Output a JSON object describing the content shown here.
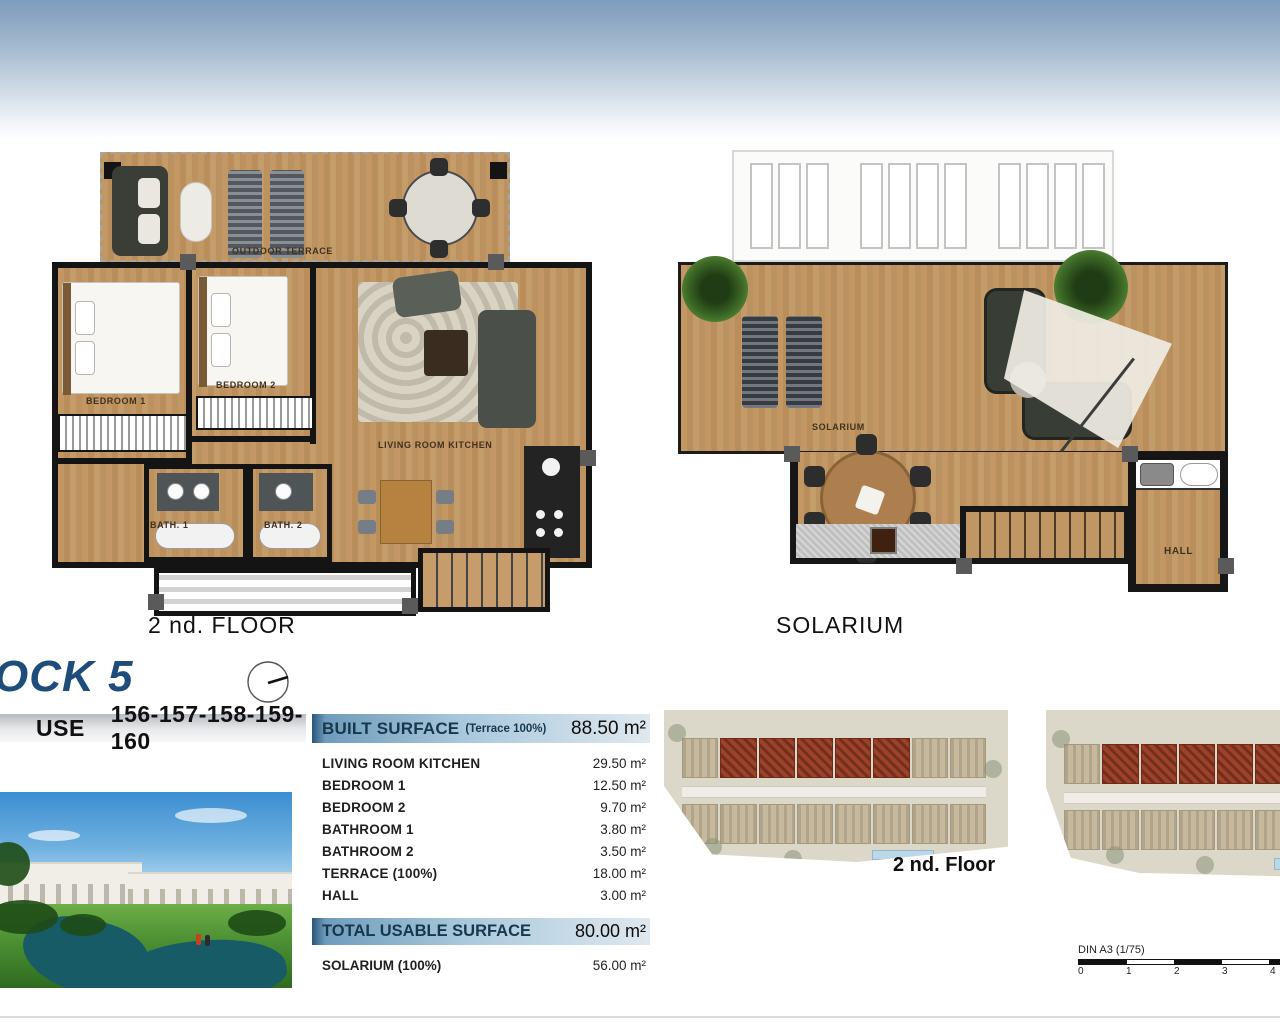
{
  "plan_floor2": {
    "caption": "2 nd. FLOOR",
    "labels": {
      "outdoor_terrace": "OUTDOOR TERRACE",
      "bedroom1": "BEDROOM 1",
      "bedroom2": "BEDROOM 2",
      "living_room_kitchen": "LIVING ROOM KITCHEN",
      "bath1": "BATH. 1",
      "bath2": "BATH. 2"
    }
  },
  "plan_solarium": {
    "caption": "SOLARIUM",
    "labels": {
      "solarium": "SOLARIUM",
      "hall": "HALL"
    }
  },
  "block": {
    "title": "OCK 5",
    "house_label": "USE",
    "house_numbers": "156-157-158-159-160"
  },
  "surface_table": {
    "built": {
      "label": "BUILT SURFACE",
      "note": "(Terrace 100%)",
      "value": "88.50 m²"
    },
    "rows": [
      {
        "label": "LIVING ROOM KITCHEN",
        "value": "29.50 m²"
      },
      {
        "label": "BEDROOM 1",
        "value": "12.50 m²"
      },
      {
        "label": "BEDROOM 2",
        "value": "9.70 m²"
      },
      {
        "label": "BATHROOM 1",
        "value": "3.80 m²"
      },
      {
        "label": "BATHROOM 2",
        "value": "3.50 m²"
      },
      {
        "label": "TERRACE (100%)",
        "value": "18.00 m²"
      },
      {
        "label": "HALL",
        "value": "3.00 m²"
      }
    ],
    "total": {
      "label": "TOTAL USABLE SURFACE",
      "value": "80.00 m²"
    },
    "solarium_row": {
      "label": "SOLARIUM (100%)",
      "value": "56.00 m²"
    }
  },
  "site_plans": {
    "caption_floor2": "2 nd. Floor"
  },
  "scale": {
    "label": "DIN A3 (1/75)",
    "ticks": [
      "0",
      "1",
      "2",
      "3",
      "4"
    ]
  },
  "colors": {
    "accent_blue": "#1e4d7b",
    "table_header_blue": "#a9c8dc",
    "highlight_red": "#9e4129",
    "wood": "#c09764",
    "sky_top": "#7e9cbc"
  }
}
